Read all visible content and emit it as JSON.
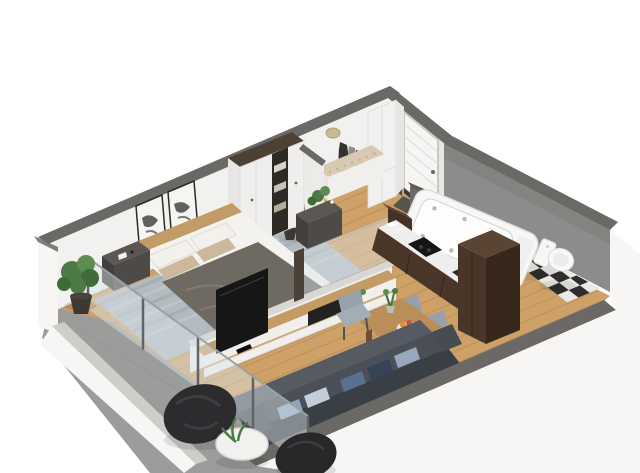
{
  "scene": {
    "label": "3d-apartment-floorplan-render",
    "background": "#ffffff"
  },
  "palette": {
    "wallCap": "#6b6965",
    "wallFace": "#f2f1ef",
    "wallFaceShade": "#e8e6e4",
    "wallOuter": "#f7f6f5",
    "bathWall": "#8d8c8a",
    "bathWallDark": "#7d7c7a",
    "wood": "#cda168",
    "woodLine": "#a87c46",
    "balcony": "#9c9c9a",
    "parapetCap": "#cfcdca",
    "rug": "#b3bac0",
    "rugStreakDark": "#9ba4a9",
    "rugStreakLight": "#c6ccce",
    "glass": "#dfe8ec",
    "glassFrame": "#8fa0a8",
    "dark": "#4e4a47",
    "darkSide": "#433f3c",
    "darkTop": "#5b5753",
    "duvet": "#6e6a62",
    "duvetFold": "#807c74",
    "mattress": "#f4f2ee",
    "pillow": "#f3f1ec",
    "pillowBeige": "#ccb89c",
    "headboard": "#c39b66",
    "consoleWood": "#c49a65",
    "consoleWhite": "#f1efec",
    "tv": "#161616",
    "cabinet": "#4a3628",
    "cabinetDark": "#38281c",
    "counter": "#efeeed",
    "cooktop": "#151515",
    "tub": "#f7f7f5",
    "tubInner": "#fdfdfc",
    "tubLine": "#d8d7d5",
    "tile": "#2e2e2e",
    "tileLight": "#e9e9e7",
    "sofa": "#4b5058",
    "sofaDark": "#3a3e45",
    "sofaLight": "#555a63",
    "chair": "#97a1ab",
    "chairLight": "#a3adb6",
    "table": "#b98e58",
    "tableEdge": "#9e7544",
    "beanbag": "#2c2c2e",
    "beanbagLight": "#3e3e42",
    "plant": "#4c7a44",
    "plantDark": "#3f6b39",
    "plantLight": "#5d8b50",
    "pot": "#3d3831",
    "cushion": "#d9c8b2",
    "tuft": "#c1ae95",
    "door": "#f6f5f3",
    "doorFrame": "#b9b7b5",
    "mat": "#57544e",
    "hat": "#cbb895",
    "coat": "#34332f",
    "coatLight": "#8f8e8a"
  },
  "rooms": [
    {
      "name": "bedroom",
      "furniture": [
        "double-bed",
        "nightstand-left",
        "nightstand-right",
        "wardrobe",
        "wall-art",
        "rug"
      ]
    },
    {
      "name": "hallway",
      "furniture": [
        "bench",
        "coat-rack",
        "closet",
        "entry-door",
        "doormat",
        "plant"
      ]
    },
    {
      "name": "bathroom",
      "furniture": [
        "jacuzzi-bathtub",
        "toilet",
        "checkered-tile-floor"
      ]
    },
    {
      "name": "kitchen",
      "furniture": [
        "counter-run",
        "cooktop",
        "sink",
        "tall-cabinet"
      ]
    },
    {
      "name": "dining-area",
      "furniture": [
        "dining-table",
        "chair",
        "chair",
        "chair",
        "fruit-bowl",
        "table-plant"
      ]
    },
    {
      "name": "living-room",
      "furniture": [
        "sofa",
        "sofa-pillows",
        "tv",
        "tv-console",
        "half-wall-glass"
      ]
    },
    {
      "name": "balcony",
      "furniture": [
        "bean-bag",
        "bean-bag",
        "round-side-table",
        "plant",
        "glass-railing"
      ]
    }
  ]
}
